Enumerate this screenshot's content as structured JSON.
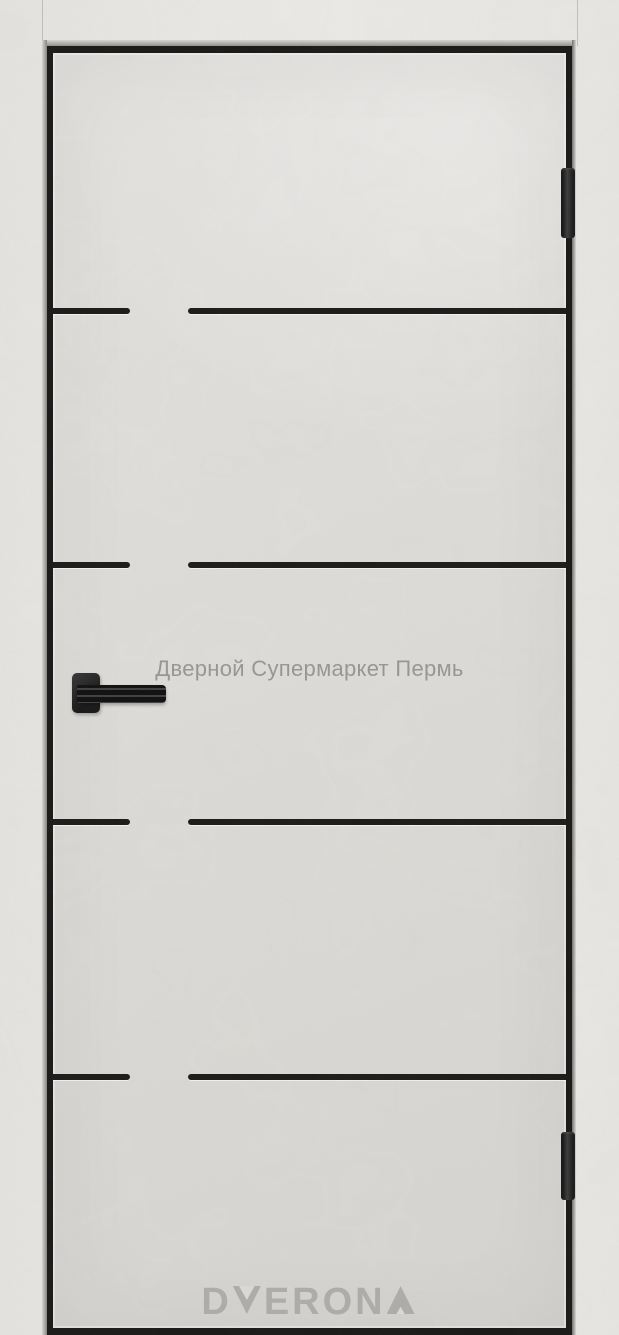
{
  "watermark": {
    "text": "Дверной Супермаркет Пермь"
  },
  "logo": {
    "text": "DVERONA",
    "prefix": "D",
    "middle": "ERON"
  },
  "colors": {
    "casing": "#eae8e5",
    "door_leaf": "#dedcd8",
    "groove_insert": "#171615",
    "gap_shadow": "#151413",
    "hardware_black": "#1b1b1b",
    "watermark_text": "#8c8c8c",
    "logo_text": "#aeaca9"
  }
}
